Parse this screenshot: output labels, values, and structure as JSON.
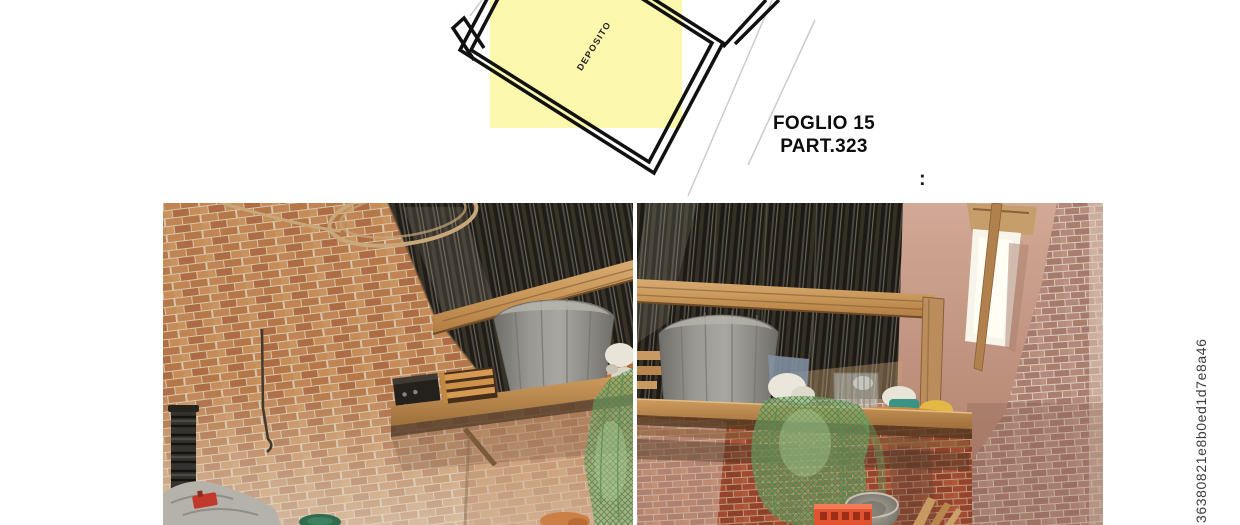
{
  "plan": {
    "room_label": "DEPOSITO",
    "highlight_color": "#fbf7ad",
    "wall_color": "#111111",
    "boundary_line_color": "#cccccc"
  },
  "caption": {
    "line1": "FOGLIO 15",
    "line2": "PART.323"
  },
  "separator_colon": ":",
  "watermark": "36380821e8b0ed1d7e8a46",
  "photos": {
    "left": {
      "alt": "Interior of brick storage room: corrugated dark metal roof, wooden beam, hanging wire loop, grey vat and wooden crate on wall shelf, screw press and grey tarpaulin below"
    },
    "right": {
      "alt": "Corner of brick storage room: corrugated metal roof, wooden beam and post, grey vat on shelf, hanging green net, small window in plastered wall, orange crate and metal bowl"
    }
  }
}
